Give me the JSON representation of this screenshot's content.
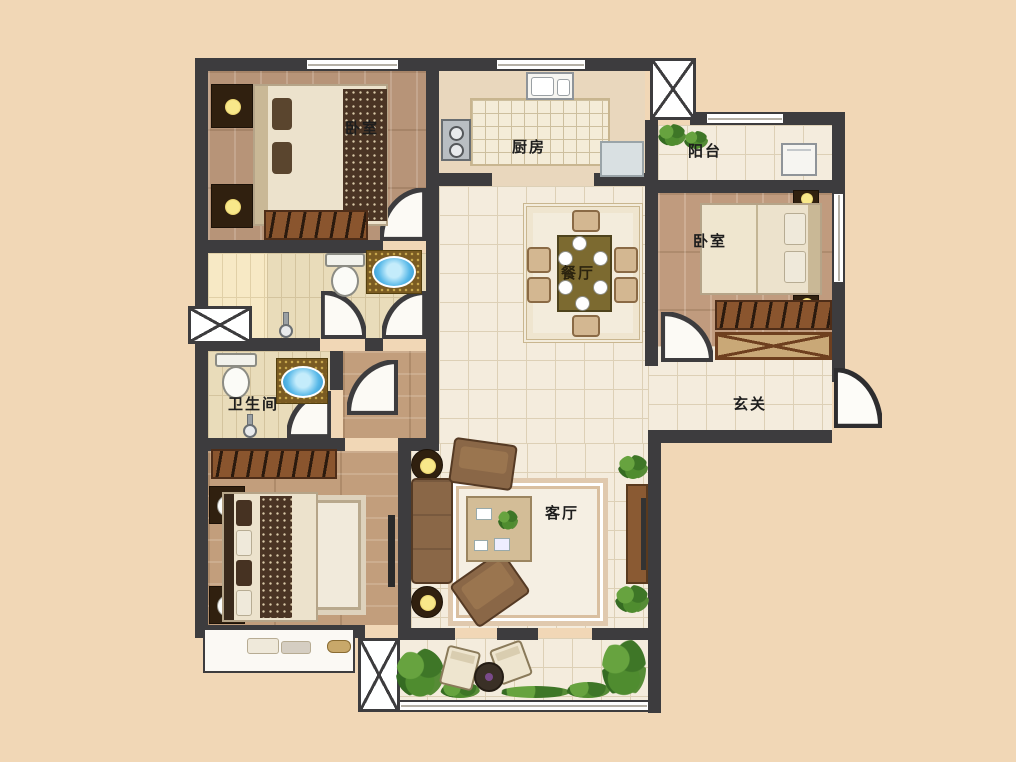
{
  "plan": {
    "type": "residential-floor-plan",
    "rooms": {
      "bedroom1": {
        "label": "卧室"
      },
      "kitchen": {
        "label": "厨房"
      },
      "balcony_top": {
        "label": "阳台"
      },
      "bedroom2": {
        "label": "卧室"
      },
      "dining": {
        "label": "餐厅"
      },
      "bathroom": {
        "label": "卫生间"
      },
      "entry": {
        "label": "玄关"
      },
      "living": {
        "label": "客厅"
      }
    },
    "colors": {
      "background": "#f1d7b6",
      "wall": "#3d3c3e",
      "wood_floor": "#b79478",
      "tile_floor": "#f4ecdd",
      "bath_tile": "#e9dcba",
      "water_blue": "#57b8e8",
      "plant_green": "#4f8c2f",
      "furniture_brown": "#8a552e",
      "label_text": "#1d1d1d"
    }
  }
}
